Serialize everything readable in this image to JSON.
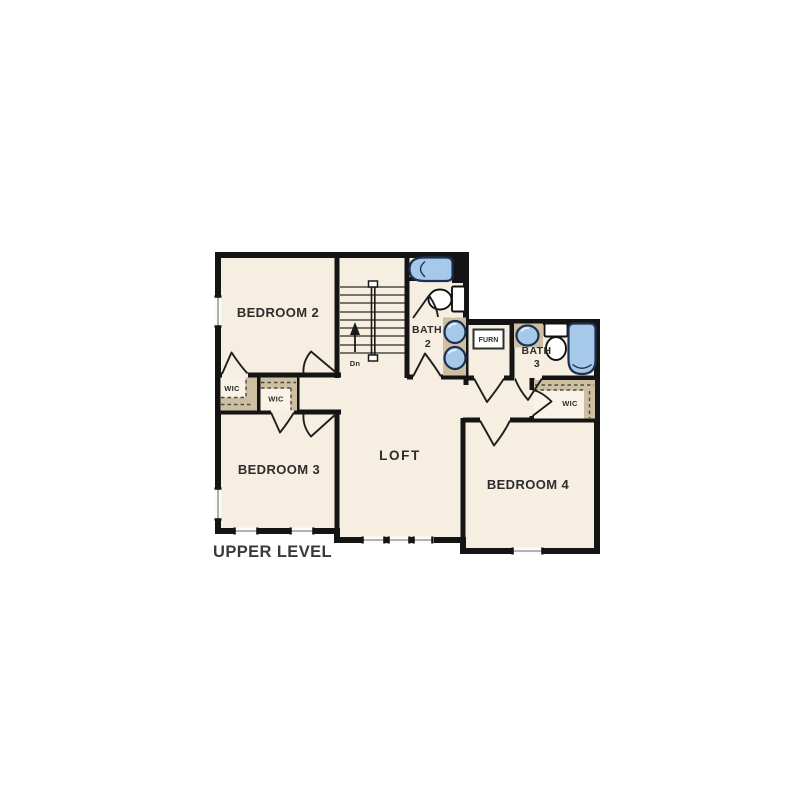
{
  "plan": {
    "title": "UPPER LEVEL",
    "labels": {
      "bedroom2": "BEDROOM 2",
      "bedroom3": "BEDROOM 3",
      "bedroom4": "BEDROOM 4",
      "loft": "LOFT",
      "bath2_name": "BATH",
      "bath2_num": "2",
      "bath3_name": "BATH",
      "bath3_num": "3",
      "furn": "FURN",
      "wic": "WIC",
      "stairs_down": "Dn"
    },
    "rooms": [
      "BEDROOM 2",
      "BEDROOM 3",
      "BEDROOM 4",
      "LOFT",
      "BATH 2",
      "BATH 3",
      "FURN",
      "WIC",
      "WIC",
      "WIC"
    ],
    "stairs": {
      "down_label": "Dn",
      "tread_count": 9
    },
    "fixtures": {
      "bath2": [
        "bathtub",
        "toilet",
        "sink",
        "sink"
      ],
      "bath3": [
        "sink",
        "toilet",
        "bathtub"
      ],
      "utility": [
        "furnace"
      ]
    },
    "window_count": 8,
    "colors": {
      "background": "#FFFFFF",
      "floor": "#F6EEE1",
      "wall": "#141414",
      "casework_tan": "#CDBF9F",
      "fixture_blue": "#A6C8E9",
      "fixture_outline": "#1E3050",
      "window_glass": "#FBFBF9",
      "window_line": "#9C9C9C",
      "label_text": "#2D2D2D",
      "title_text": "#3A3A3A"
    }
  }
}
